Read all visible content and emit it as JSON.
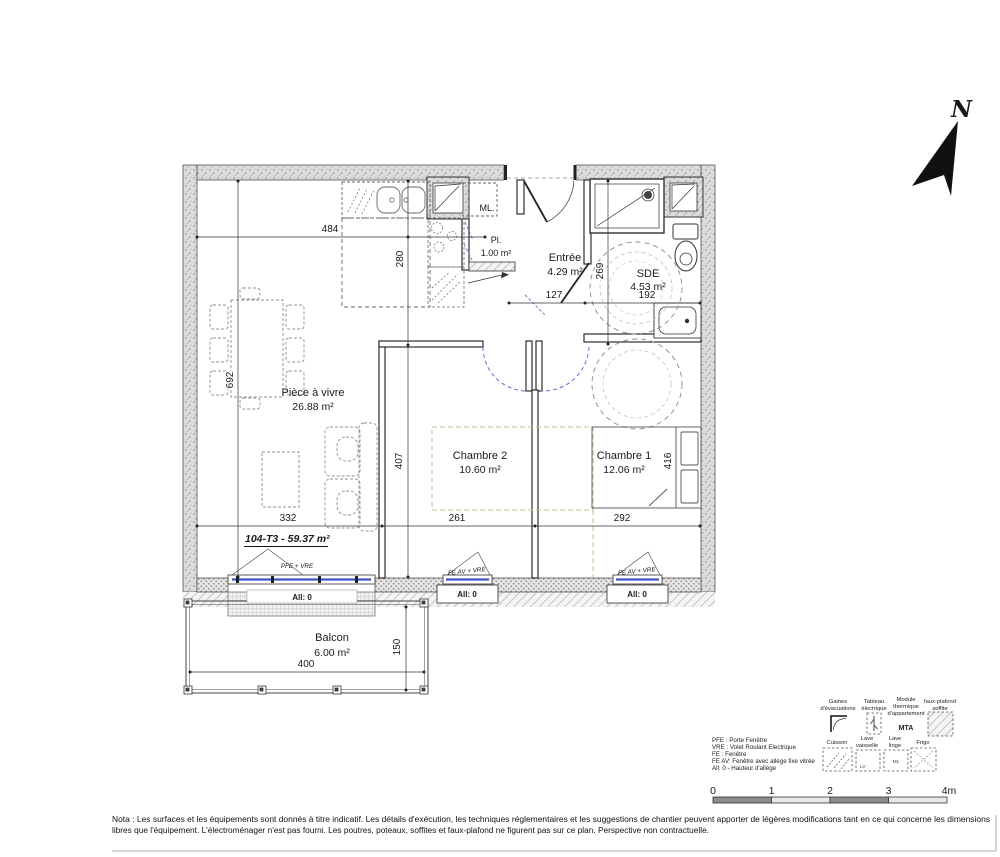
{
  "plan": {
    "unit_title": "104-T3 - 59.37 m²",
    "north": "N",
    "rooms": {
      "living": {
        "name": "Pièce à vivre",
        "area": "26.88 m²"
      },
      "chambre2": {
        "name": "Chambre 2",
        "area": "10.60 m²"
      },
      "chambre1": {
        "name": "Chambre 1",
        "area": "12.06 m²"
      },
      "entree": {
        "name": "Entrée",
        "area": "4.29 m²"
      },
      "sde": {
        "name": "SDE",
        "area": "4.53 m²"
      },
      "placard": {
        "name": "Pl.",
        "area": "1.00 m²"
      },
      "balcon": {
        "name": "Balcon",
        "area": "6.00 m²"
      }
    },
    "labels": {
      "ml": "ML.",
      "pfe_window": "PFE + VRE",
      "feav_window": "FE AV + VRE",
      "allege": "All: 0"
    },
    "dims": {
      "d484": "484",
      "d280": "280",
      "d692": "692",
      "d407": "407",
      "d332": "332",
      "d261": "261",
      "d292": "292",
      "d416": "416",
      "d269": "269",
      "d192": "192",
      "d127": "127",
      "d400": "400",
      "d150": "150"
    }
  },
  "legend": {
    "abbr": [
      "PFE :  Porte Fenêtre",
      "VRE :  Volet Roulant Electrique",
      "FE :    Fenêtre",
      "FE AV: Fenêtre avec allège fixe vitrée",
      "All: 0  - Hauteur d'allège"
    ],
    "row1": [
      {
        "l1": "Gaines",
        "l2": "d'évacuations",
        "l3": ""
      },
      {
        "l1": "Tableau",
        "l2": "électrique",
        "l3": ""
      },
      {
        "l1": "Module",
        "l2": "thermique",
        "l3": "d'appartement"
      },
      {
        "l1": "faux-plafond",
        "l2": "soffite",
        "l3": ""
      }
    ],
    "row2": [
      {
        "l1": "Cuisson",
        "l2": ""
      },
      {
        "l1": "Lave",
        "l2": "vaisselle"
      },
      {
        "l1": "Lave",
        "l2": "linge"
      },
      {
        "l1": "Frigo",
        "l2": ""
      }
    ],
    "mta": "MTA",
    "lv": "LV",
    "ml": "ML"
  },
  "scalebar": {
    "t0": "0",
    "t1": "1",
    "t2": "2",
    "t3": "3",
    "t4": "4m"
  },
  "nota": {
    "line1": "Nota : Les surfaces et les équipements sont donnés à titre indicatif. Les détails d'exécution, les techniques réglementaires et les suggestions de chantier peuvent apporter de légères modifications tant en ce qui concerne les dimensions",
    "line2": "libres que l'équipement. L'électroménager n'est pas fourni. Les poutres, poteaux, soffites et faux-plafond ne figurent pas sur ce plan. Perspective non contractuelle."
  },
  "colors": {
    "glazing": "#3d55cc",
    "door_arc": "#6b6bd9",
    "soffit": "#c9bf8f",
    "mta_blue": "#2330b4"
  }
}
